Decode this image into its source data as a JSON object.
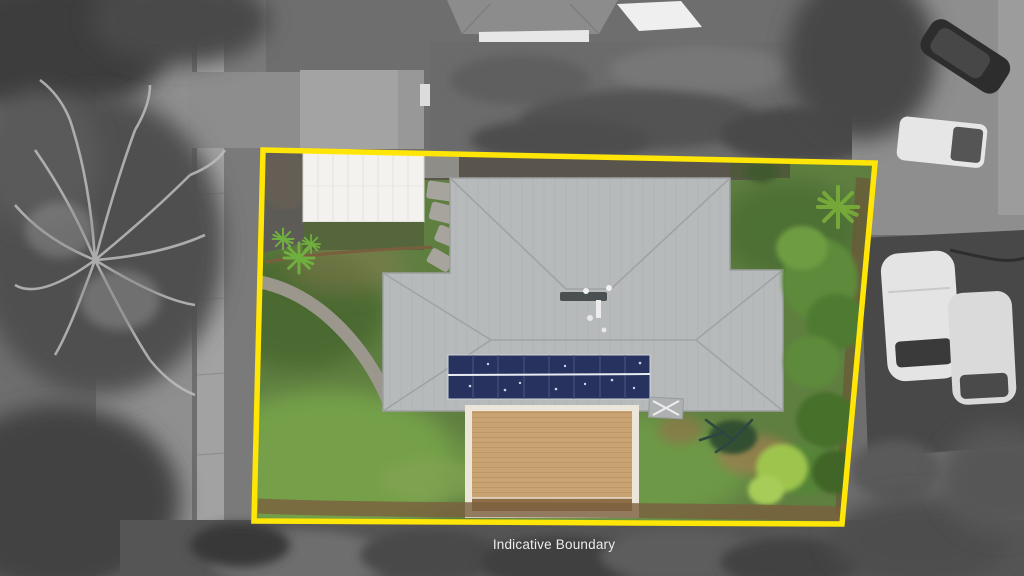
{
  "overlay": {
    "boundary_label": "Indicative Boundary",
    "boundary_color": "#FFE607",
    "label_color": "#ECECEC",
    "boundary_points": [
      [
        263,
        150
      ],
      [
        875,
        163
      ],
      [
        842,
        524
      ],
      [
        254,
        521
      ]
    ]
  },
  "scene": {
    "type": "aerial-drone-photo",
    "treatment": "surroundings-grayscale, subject-property-in-color",
    "property": {
      "roof_color": "#b7babb",
      "solar_panel_color": "#27335e",
      "solar_panel_rows": 2,
      "solar_panel_columns": 8,
      "deck_color": "#c9a372",
      "deck_frame_color": "#ece6da",
      "carport_roof_color": "#f3f2ee",
      "lawn_color": "#5f7f41",
      "driveway_color": "#5d5b56"
    }
  }
}
